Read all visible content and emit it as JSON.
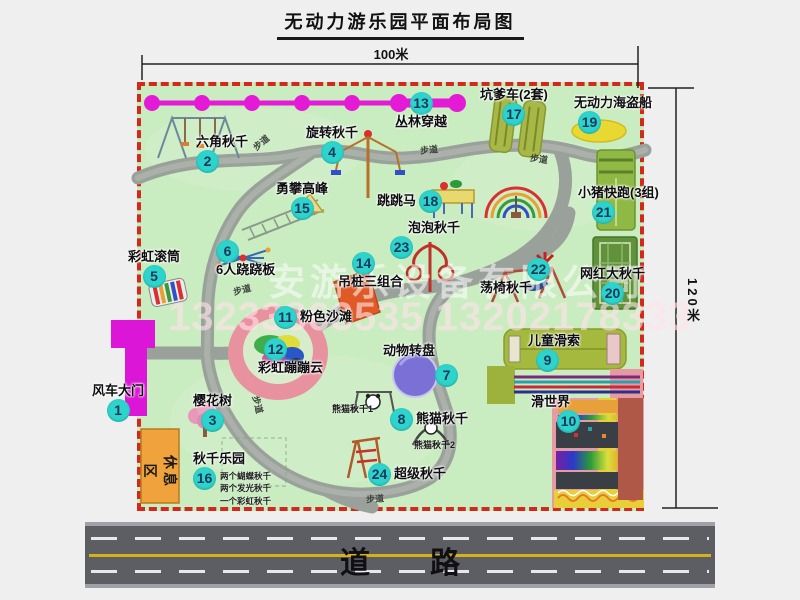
{
  "title": "无动力游乐园平面布局图",
  "dimensions": {
    "width": "100米",
    "height": "120米"
  },
  "road": {
    "label": "道　　路"
  },
  "rest_area": {
    "label": "休息区"
  },
  "walkway": {
    "label": "步道"
  },
  "watermark": {
    "company": "安游乐设备有限公司",
    "phone": "13233863535 13202178333"
  },
  "attractions": [
    {
      "num": "1",
      "name": "风车大门"
    },
    {
      "num": "2",
      "name": "六角秋千"
    },
    {
      "num": "3",
      "name": "樱花树"
    },
    {
      "num": "4",
      "name": "旋转秋千"
    },
    {
      "num": "5",
      "name": "彩虹滚筒"
    },
    {
      "num": "6",
      "name": "6人跷跷板"
    },
    {
      "num": "7",
      "name": "动物转盘"
    },
    {
      "num": "8",
      "name": "熊猫秋千"
    },
    {
      "num": "9",
      "name": "儿童滑索"
    },
    {
      "num": "10",
      "name": "滑世界"
    },
    {
      "num": "11",
      "name": "粉色沙滩"
    },
    {
      "num": "12",
      "name": "彩虹蹦蹦云"
    },
    {
      "num": "13",
      "name": "丛林穿越"
    },
    {
      "num": "14",
      "name": "吊桩三组合"
    },
    {
      "num": "15",
      "name": "勇攀高峰"
    },
    {
      "num": "16",
      "name": "秋千乐园"
    },
    {
      "num": "17",
      "name": "坑爹车(2套)"
    },
    {
      "num": "18",
      "name": "跳跳马"
    },
    {
      "num": "19",
      "name": "无动力海盗船"
    },
    {
      "num": "20",
      "name": "网红大秋千"
    },
    {
      "num": "21",
      "name": "小猪快跑(3组)"
    },
    {
      "num": "22",
      "name": "荡椅秋千"
    },
    {
      "num": "23",
      "name": "泡泡秋千"
    },
    {
      "num": "24",
      "name": "超级秋千"
    }
  ],
  "sub_labels": {
    "swing_park_notes": [
      "两个蝴蝶秋千",
      "两个发光秋千",
      "一个彩虹秋千"
    ],
    "panda_swing_1": "熊猫秋千1",
    "panda_swing_2": "熊猫秋千2"
  },
  "colors": {
    "map_green": "#c9ecc0",
    "border_red": "#d3281c",
    "badge_teal": "#2ed3cc",
    "magenta": "#e01ad6",
    "path_gray": "#9ba29b",
    "road_gray": "#5d5d64",
    "rest_orange": "#f0a23c"
  }
}
